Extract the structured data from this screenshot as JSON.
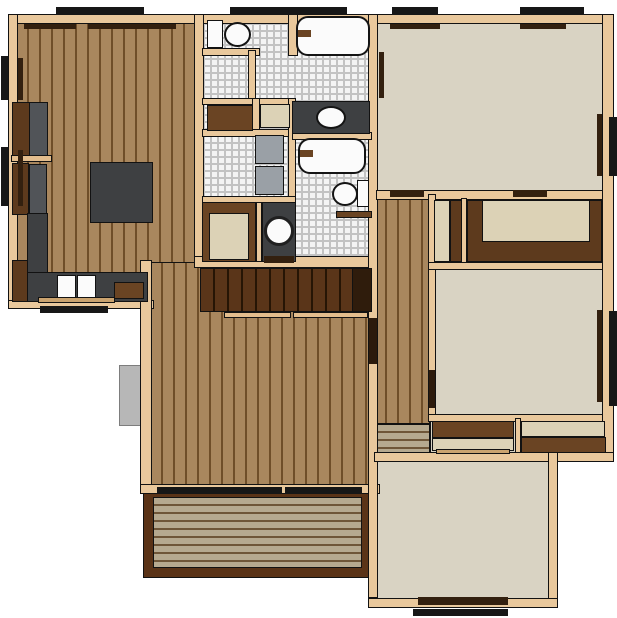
{
  "canvas": {
    "w": 617,
    "h": 618,
    "bg": "#ffffff"
  },
  "palette": {
    "wall": "#e9c89c",
    "wood": "#a9875e",
    "woodLine": "#6f4e29",
    "carpet": "#d9d3c3",
    "tileFace": "#f4f4f4",
    "grout": "#c3c3c3",
    "deck": "#b6a98f",
    "deckLine": "#6f5638",
    "deckFrame": "#5a3317",
    "counter": "#3e4042",
    "cabinet": "#5d3a1d",
    "shelfBrown": "#6a4423",
    "beige": "#dcd2b6",
    "white": "#fbfbfb",
    "black": "#171717",
    "sill": "#33200f",
    "doorDark": "#2c1a0c",
    "gray": "#9aa0a6",
    "appliance": "#515458",
    "stair": "#5a3519",
    "stairLine": "#261505",
    "railing": "#e3bd8d",
    "boxGray": "#b7b7b7",
    "tanBar": "#caa36f",
    "stairEnd": "#2f1c0c"
  },
  "layer_order": [
    "floors",
    "exterior",
    "walls",
    "fixtures",
    "stairs",
    "closets",
    "openings",
    "windows"
  ],
  "layers": {
    "floors": [
      {
        "n": "kitchen-dining-floor",
        "k": "wood-v",
        "x": 16,
        "y": 22,
        "w": 184,
        "h": 282
      },
      {
        "n": "living-room-floor",
        "k": "wood-v",
        "x": 150,
        "y": 262,
        "w": 222,
        "h": 226
      },
      {
        "n": "hallway-floor",
        "k": "wood-v",
        "x": 374,
        "y": 194,
        "w": 56,
        "h": 230
      },
      {
        "n": "entry-steps",
        "k": "deckp",
        "x": 376,
        "y": 424,
        "w": 54,
        "h": 30
      },
      {
        "n": "bathroom-block-floor",
        "k": "tile",
        "x": 202,
        "y": 22,
        "w": 168,
        "h": 240
      },
      {
        "n": "bedroom-top-right-floor",
        "k": "carpet",
        "c": "carpet",
        "x": 376,
        "y": 22,
        "w": 228,
        "h": 172
      },
      {
        "n": "closet-row-floor",
        "k": "carpet",
        "c": "carpet",
        "x": 430,
        "y": 196,
        "w": 174,
        "h": 72
      },
      {
        "n": "bedroom-mid-right-floor",
        "k": "carpet",
        "c": "carpet",
        "x": 430,
        "y": 268,
        "w": 174,
        "h": 150
      },
      {
        "n": "closet-row2-floor",
        "k": "carpet",
        "c": "carpet",
        "x": 430,
        "y": 418,
        "w": 176,
        "h": 40
      },
      {
        "n": "bedroom-bottom-right-floor",
        "k": "carpet",
        "c": "carpet",
        "x": 376,
        "y": 456,
        "w": 176,
        "h": 146
      },
      {
        "n": "deck-frame",
        "k": "rect",
        "c": "deckFrame",
        "x": 143,
        "y": 488,
        "w": 229,
        "h": 90
      },
      {
        "n": "deck-planks",
        "k": "deckp",
        "x": 153,
        "y": 497,
        "w": 209,
        "h": 71
      }
    ],
    "exterior": [
      {
        "n": "utility-box",
        "k": "boxg",
        "c": "boxGray",
        "x": 119,
        "y": 365,
        "w": 24,
        "h": 61
      }
    ],
    "walls": [
      {
        "n": "wall-top",
        "k": "wall",
        "c": "wall",
        "x": 8,
        "y": 14,
        "w": 604,
        "h": 10
      },
      {
        "n": "wall-left",
        "k": "wall",
        "c": "wall",
        "x": 8,
        "y": 14,
        "w": 10,
        "h": 295
      },
      {
        "n": "wall-kitchen-bottom",
        "k": "wall",
        "c": "wall",
        "x": 8,
        "y": 300,
        "w": 146,
        "h": 9
      },
      {
        "n": "wall-west-lower",
        "k": "wall",
        "c": "wall",
        "x": 140,
        "y": 260,
        "w": 12,
        "h": 232
      },
      {
        "n": "wall-living-bottom",
        "k": "wall",
        "c": "wall",
        "x": 140,
        "y": 484,
        "w": 240,
        "h": 10
      },
      {
        "n": "wall-bath-west",
        "k": "wall",
        "c": "wall",
        "x": 194,
        "y": 14,
        "w": 10,
        "h": 252
      },
      {
        "n": "wall-stairs-top",
        "k": "wall",
        "c": "wall",
        "x": 194,
        "y": 256,
        "w": 182,
        "h": 12
      },
      {
        "n": "wall-center-spine",
        "k": "wall",
        "c": "wall",
        "x": 368,
        "y": 14,
        "w": 10,
        "h": 584
      },
      {
        "n": "wall-bedroom-tr-bottom",
        "k": "wall",
        "c": "wall",
        "x": 376,
        "y": 190,
        "w": 230,
        "h": 10
      },
      {
        "n": "wall-hall-east",
        "k": "wall",
        "c": "wall",
        "x": 428,
        "y": 194,
        "w": 8,
        "h": 226
      },
      {
        "n": "wall-closet-divider",
        "k": "wall",
        "c": "wall",
        "x": 461,
        "y": 198,
        "w": 6,
        "h": 70
      },
      {
        "n": "wall-closet-row-bottom",
        "k": "wall",
        "c": "wall",
        "x": 428,
        "y": 262,
        "w": 178,
        "h": 8
      },
      {
        "n": "wall-bedroom-mr-bottom",
        "k": "wall",
        "c": "wall",
        "x": 428,
        "y": 414,
        "w": 178,
        "h": 8
      },
      {
        "n": "wall-closet2-divider",
        "k": "wall",
        "c": "wall",
        "x": 515,
        "y": 418,
        "w": 6,
        "h": 40
      },
      {
        "n": "wall-closet2-bottom",
        "k": "wall",
        "c": "wall",
        "x": 374,
        "y": 452,
        "w": 232,
        "h": 10
      },
      {
        "n": "wall-east-upper",
        "k": "wall",
        "c": "wall",
        "x": 602,
        "y": 14,
        "w": 12,
        "h": 448
      },
      {
        "n": "wall-step-right",
        "k": "wall",
        "c": "wall",
        "x": 552,
        "y": 452,
        "w": 62,
        "h": 10
      },
      {
        "n": "wall-east-lower",
        "k": "wall",
        "c": "wall",
        "x": 548,
        "y": 452,
        "w": 10,
        "h": 156
      },
      {
        "n": "wall-bottom-right",
        "k": "wall",
        "c": "wall",
        "x": 368,
        "y": 598,
        "w": 190,
        "h": 10
      },
      {
        "n": "wall-toilet-stub",
        "k": "wall",
        "c": "wall",
        "x": 202,
        "y": 48,
        "w": 58,
        "h": 8
      },
      {
        "n": "wall-toilet-stub-v",
        "k": "wall",
        "c": "wall",
        "x": 248,
        "y": 50,
        "w": 8,
        "h": 56
      },
      {
        "n": "wall-tub1-west",
        "k": "wall",
        "c": "wall",
        "x": 288,
        "y": 14,
        "w": 10,
        "h": 42
      },
      {
        "n": "wall-shelfband-top",
        "k": "wall",
        "c": "wall",
        "x": 202,
        "y": 98,
        "w": 90,
        "h": 7
      },
      {
        "n": "wall-shelfband-mid",
        "k": "wall",
        "c": "wall",
        "x": 252,
        "y": 98,
        "w": 8,
        "h": 38
      },
      {
        "n": "wall-shelfband-bottom",
        "k": "wall",
        "c": "wall",
        "x": 202,
        "y": 129,
        "w": 90,
        "h": 8
      },
      {
        "n": "wall-laundry-east",
        "k": "wall",
        "c": "wall",
        "x": 288,
        "y": 98,
        "w": 8,
        "h": 106
      },
      {
        "n": "wall-tub2-top",
        "k": "wall",
        "c": "wall",
        "x": 292,
        "y": 132,
        "w": 80,
        "h": 8
      },
      {
        "n": "wall-laundry-bottom",
        "k": "wall",
        "c": "wall",
        "x": 202,
        "y": 196,
        "w": 94,
        "h": 8
      },
      {
        "n": "wall-vanity2-west",
        "k": "wall",
        "c": "wall",
        "x": 256,
        "y": 202,
        "w": 6,
        "h": 60
      }
    ],
    "fixtures": [
      {
        "n": "cabinet-upper",
        "k": "rect",
        "c": "cabinet",
        "x": 12,
        "y": 102,
        "w": 18,
        "h": 56
      },
      {
        "n": "refrigerator",
        "k": "rect",
        "c": "appliance",
        "x": 29,
        "y": 102,
        "w": 19,
        "h": 54
      },
      {
        "n": "counter-shelf",
        "k": "rect",
        "c": "railing",
        "x": 11,
        "y": 155,
        "w": 41,
        "h": 7
      },
      {
        "n": "cabinet-lower",
        "k": "rect",
        "c": "cabinet",
        "x": 12,
        "y": 163,
        "w": 17,
        "h": 52
      },
      {
        "n": "appliance-oven",
        "k": "rect",
        "c": "appliance",
        "x": 29,
        "y": 164,
        "w": 18,
        "h": 50
      },
      {
        "n": "kitchen-island",
        "k": "rect",
        "c": "counter",
        "x": 90,
        "y": 162,
        "w": 63,
        "h": 61
      },
      {
        "n": "kitchen-counter-left",
        "k": "rect",
        "c": "counter",
        "x": 27,
        "y": 213,
        "w": 21,
        "h": 62
      },
      {
        "n": "kitchen-counter-bottom",
        "k": "rect",
        "c": "counter",
        "x": 27,
        "y": 272,
        "w": 121,
        "h": 30
      },
      {
        "n": "cabinet-corner",
        "k": "rect",
        "c": "cabinet",
        "x": 12,
        "y": 260,
        "w": 16,
        "h": 42
      },
      {
        "n": "sink-basin-left",
        "k": "rect",
        "c": "white",
        "x": 57,
        "y": 275,
        "w": 19,
        "h": 24
      },
      {
        "n": "sink-basin-right",
        "k": "rect",
        "c": "white",
        "x": 77,
        "y": 275,
        "w": 19,
        "h": 24
      },
      {
        "n": "cutting-board",
        "k": "rect",
        "c": "shelfBrown",
        "x": 114,
        "y": 282,
        "w": 30,
        "h": 17
      },
      {
        "n": "counter-edge",
        "k": "rect",
        "c": "tanBar",
        "x": 38,
        "y": 297,
        "w": 77,
        "h": 6
      },
      {
        "n": "toilet1-tank",
        "k": "rect",
        "c": "white",
        "x": 207,
        "y": 20,
        "w": 16,
        "h": 28
      },
      {
        "n": "toilet1-bowl",
        "k": "ellipse",
        "c": "white",
        "x": 224,
        "y": 22,
        "w": 27,
        "h": 25
      },
      {
        "n": "bathtub-1",
        "k": "tub",
        "c": "white",
        "x": 296,
        "y": 16,
        "w": 74,
        "h": 40
      },
      {
        "n": "tub1-faucet",
        "k": "flat",
        "c": "shelfBrown",
        "x": 298,
        "y": 30,
        "w": 13,
        "h": 7
      },
      {
        "n": "linen-shelf-brown",
        "k": "rect",
        "c": "shelfBrown",
        "x": 207,
        "y": 105,
        "w": 46,
        "h": 26
      },
      {
        "n": "linen-shelf-beige",
        "k": "rect",
        "c": "beige",
        "x": 260,
        "y": 104,
        "w": 30,
        "h": 24
      },
      {
        "n": "vanity-1",
        "k": "rect",
        "c": "counter",
        "x": 292,
        "y": 101,
        "w": 78,
        "h": 33
      },
      {
        "n": "vanity1-sink",
        "k": "ellipse",
        "c": "white",
        "x": 316,
        "y": 106,
        "w": 30,
        "h": 23
      },
      {
        "n": "washer",
        "k": "rect",
        "c": "gray",
        "x": 255,
        "y": 135,
        "w": 29,
        "h": 29
      },
      {
        "n": "dryer",
        "k": "rect",
        "c": "gray",
        "x": 255,
        "y": 166,
        "w": 29,
        "h": 29
      },
      {
        "n": "bathtub-2",
        "k": "tub",
        "c": "white",
        "x": 298,
        "y": 138,
        "w": 68,
        "h": 36
      },
      {
        "n": "tub2-faucet",
        "k": "flat",
        "c": "shelfBrown",
        "x": 300,
        "y": 150,
        "w": 13,
        "h": 7
      },
      {
        "n": "toilet2-bowl",
        "k": "ellipse",
        "c": "white",
        "x": 332,
        "y": 182,
        "w": 26,
        "h": 24
      },
      {
        "n": "toilet2-tank",
        "k": "rect",
        "c": "white",
        "x": 357,
        "y": 180,
        "w": 12,
        "h": 27
      },
      {
        "n": "half-wall",
        "k": "rect",
        "c": "shelfBrown",
        "x": 336,
        "y": 211,
        "w": 36,
        "h": 7
      },
      {
        "n": "closet-bath",
        "k": "rect",
        "c": "shelfBrown",
        "x": 202,
        "y": 202,
        "w": 54,
        "h": 60
      },
      {
        "n": "closet-bath-floor",
        "k": "rect",
        "c": "beige",
        "x": 209,
        "y": 213,
        "w": 40,
        "h": 47
      },
      {
        "n": "vanity-2",
        "k": "rect",
        "c": "counter",
        "x": 262,
        "y": 202,
        "w": 34,
        "h": 60
      },
      {
        "n": "vanity2-sink",
        "k": "circle",
        "c": "white",
        "x": 264,
        "y": 216,
        "w": 30,
        "h": 30
      }
    ],
    "stairs": [
      {
        "n": "staircase",
        "k": "stairs",
        "x": 200,
        "y": 268,
        "w": 172,
        "h": 44
      },
      {
        "n": "staircase-end",
        "k": "rect",
        "c": "stairEnd",
        "x": 352,
        "y": 268,
        "w": 20,
        "h": 44
      },
      {
        "n": "stair-railing-left",
        "k": "rect",
        "c": "railing",
        "x": 224,
        "y": 312,
        "w": 67,
        "h": 6
      },
      {
        "n": "stair-railing-right",
        "k": "rect",
        "c": "railing",
        "x": 293,
        "y": 312,
        "w": 75,
        "h": 6
      }
    ],
    "closets": [
      {
        "n": "closet-narrow-floor",
        "k": "rect",
        "c": "beige",
        "x": 434,
        "y": 200,
        "w": 16,
        "h": 62
      },
      {
        "n": "closet-narrow-door",
        "k": "rect",
        "c": "cabinet",
        "x": 450,
        "y": 200,
        "w": 12,
        "h": 62
      },
      {
        "n": "closet-wide-shelf",
        "k": "rect",
        "c": "cabinet",
        "x": 467,
        "y": 200,
        "w": 135,
        "h": 62
      },
      {
        "n": "closet-wide-floor",
        "k": "rect",
        "c": "beige",
        "x": 482,
        "y": 200,
        "w": 108,
        "h": 42
      },
      {
        "n": "closet2-left-shelf",
        "k": "rect",
        "c": "shelfBrown",
        "x": 432,
        "y": 421,
        "w": 82,
        "h": 17
      },
      {
        "n": "closet2-left-floor",
        "k": "rect",
        "c": "beige",
        "x": 432,
        "y": 438,
        "w": 82,
        "h": 13
      },
      {
        "n": "closet2-left-bar",
        "k": "rect",
        "c": "tanBar",
        "x": 436,
        "y": 449,
        "w": 74,
        "h": 5
      },
      {
        "n": "closet2-right-floor",
        "k": "rect",
        "c": "beige",
        "x": 521,
        "y": 421,
        "w": 84,
        "h": 16
      },
      {
        "n": "closet2-right-shelf",
        "k": "rect",
        "c": "shelfBrown",
        "x": 521,
        "y": 437,
        "w": 85,
        "h": 16
      }
    ],
    "openings": [
      {
        "n": "sill-kitchen-top-a",
        "k": "flat",
        "c": "sill",
        "x": 24,
        "y": 24,
        "w": 52,
        "h": 5
      },
      {
        "n": "sill-kitchen-top-b",
        "k": "flat",
        "c": "sill",
        "x": 88,
        "y": 24,
        "w": 88,
        "h": 5
      },
      {
        "n": "sill-left-a",
        "k": "flat",
        "c": "sill",
        "x": 18,
        "y": 58,
        "w": 5,
        "h": 42
      },
      {
        "n": "sill-left-b",
        "k": "flat",
        "c": "sill",
        "x": 18,
        "y": 150,
        "w": 5,
        "h": 56
      },
      {
        "n": "door-hall-living",
        "k": "flat",
        "c": "doorDark",
        "x": 369,
        "y": 318,
        "w": 8,
        "h": 46
      },
      {
        "n": "door-deck-a",
        "k": "flat",
        "c": "black",
        "x": 157,
        "y": 487,
        "w": 125,
        "h": 7
      },
      {
        "n": "door-deck-b",
        "k": "flat",
        "c": "black",
        "x": 285,
        "y": 487,
        "w": 77,
        "h": 7
      },
      {
        "n": "sill-bedroomtr-top-a",
        "k": "flat",
        "c": "sill",
        "x": 390,
        "y": 24,
        "w": 50,
        "h": 5
      },
      {
        "n": "sill-bedroomtr-top-b",
        "k": "flat",
        "c": "sill",
        "x": 520,
        "y": 24,
        "w": 46,
        "h": 5
      },
      {
        "n": "sill-bedroomtr-left",
        "k": "flat",
        "c": "sill",
        "x": 379,
        "y": 52,
        "w": 5,
        "h": 46
      },
      {
        "n": "sill-bedroomtr-right",
        "k": "flat",
        "c": "sill",
        "x": 597,
        "y": 114,
        "w": 5,
        "h": 62
      },
      {
        "n": "door-bedroomtr-a",
        "k": "flat",
        "c": "sill",
        "x": 390,
        "y": 190,
        "w": 34,
        "h": 7
      },
      {
        "n": "door-bedroomtr-b",
        "k": "flat",
        "c": "sill",
        "x": 513,
        "y": 190,
        "w": 34,
        "h": 7
      },
      {
        "n": "sill-bedroommr-right",
        "k": "flat",
        "c": "sill",
        "x": 597,
        "y": 310,
        "w": 5,
        "h": 92
      },
      {
        "n": "door-bedroommr",
        "k": "flat",
        "c": "doorDark",
        "x": 429,
        "y": 370,
        "w": 6,
        "h": 38
      },
      {
        "n": "door-bath-hall",
        "k": "flat",
        "c": "sill",
        "x": 264,
        "y": 256,
        "w": 30,
        "h": 7
      },
      {
        "n": "door-bedroombr",
        "k": "flat",
        "c": "sill",
        "x": 418,
        "y": 597,
        "w": 90,
        "h": 8
      }
    ],
    "windows": [
      {
        "n": "window-top-a",
        "k": "flat",
        "c": "black",
        "x": 56,
        "y": 7,
        "w": 88,
        "h": 8
      },
      {
        "n": "window-top-b",
        "k": "flat",
        "c": "black",
        "x": 230,
        "y": 7,
        "w": 117,
        "h": 8
      },
      {
        "n": "window-top-c",
        "k": "flat",
        "c": "black",
        "x": 392,
        "y": 7,
        "w": 46,
        "h": 8
      },
      {
        "n": "window-top-d",
        "k": "flat",
        "c": "black",
        "x": 520,
        "y": 7,
        "w": 64,
        "h": 8
      },
      {
        "n": "window-left-a",
        "k": "flat",
        "c": "black",
        "x": 1,
        "y": 56,
        "w": 7,
        "h": 44
      },
      {
        "n": "window-left-b",
        "k": "flat",
        "c": "black",
        "x": 1,
        "y": 147,
        "w": 7,
        "h": 59
      },
      {
        "n": "window-right-a",
        "k": "flat",
        "c": "black",
        "x": 609,
        "y": 117,
        "w": 8,
        "h": 59
      },
      {
        "n": "window-right-b",
        "k": "flat",
        "c": "black",
        "x": 609,
        "y": 311,
        "w": 8,
        "h": 95
      },
      {
        "n": "window-kitchen-south",
        "k": "flat",
        "c": "black",
        "x": 40,
        "y": 306,
        "w": 68,
        "h": 7
      },
      {
        "n": "stoop-south",
        "k": "flat",
        "c": "black",
        "x": 413,
        "y": 609,
        "w": 95,
        "h": 7
      }
    ]
  }
}
